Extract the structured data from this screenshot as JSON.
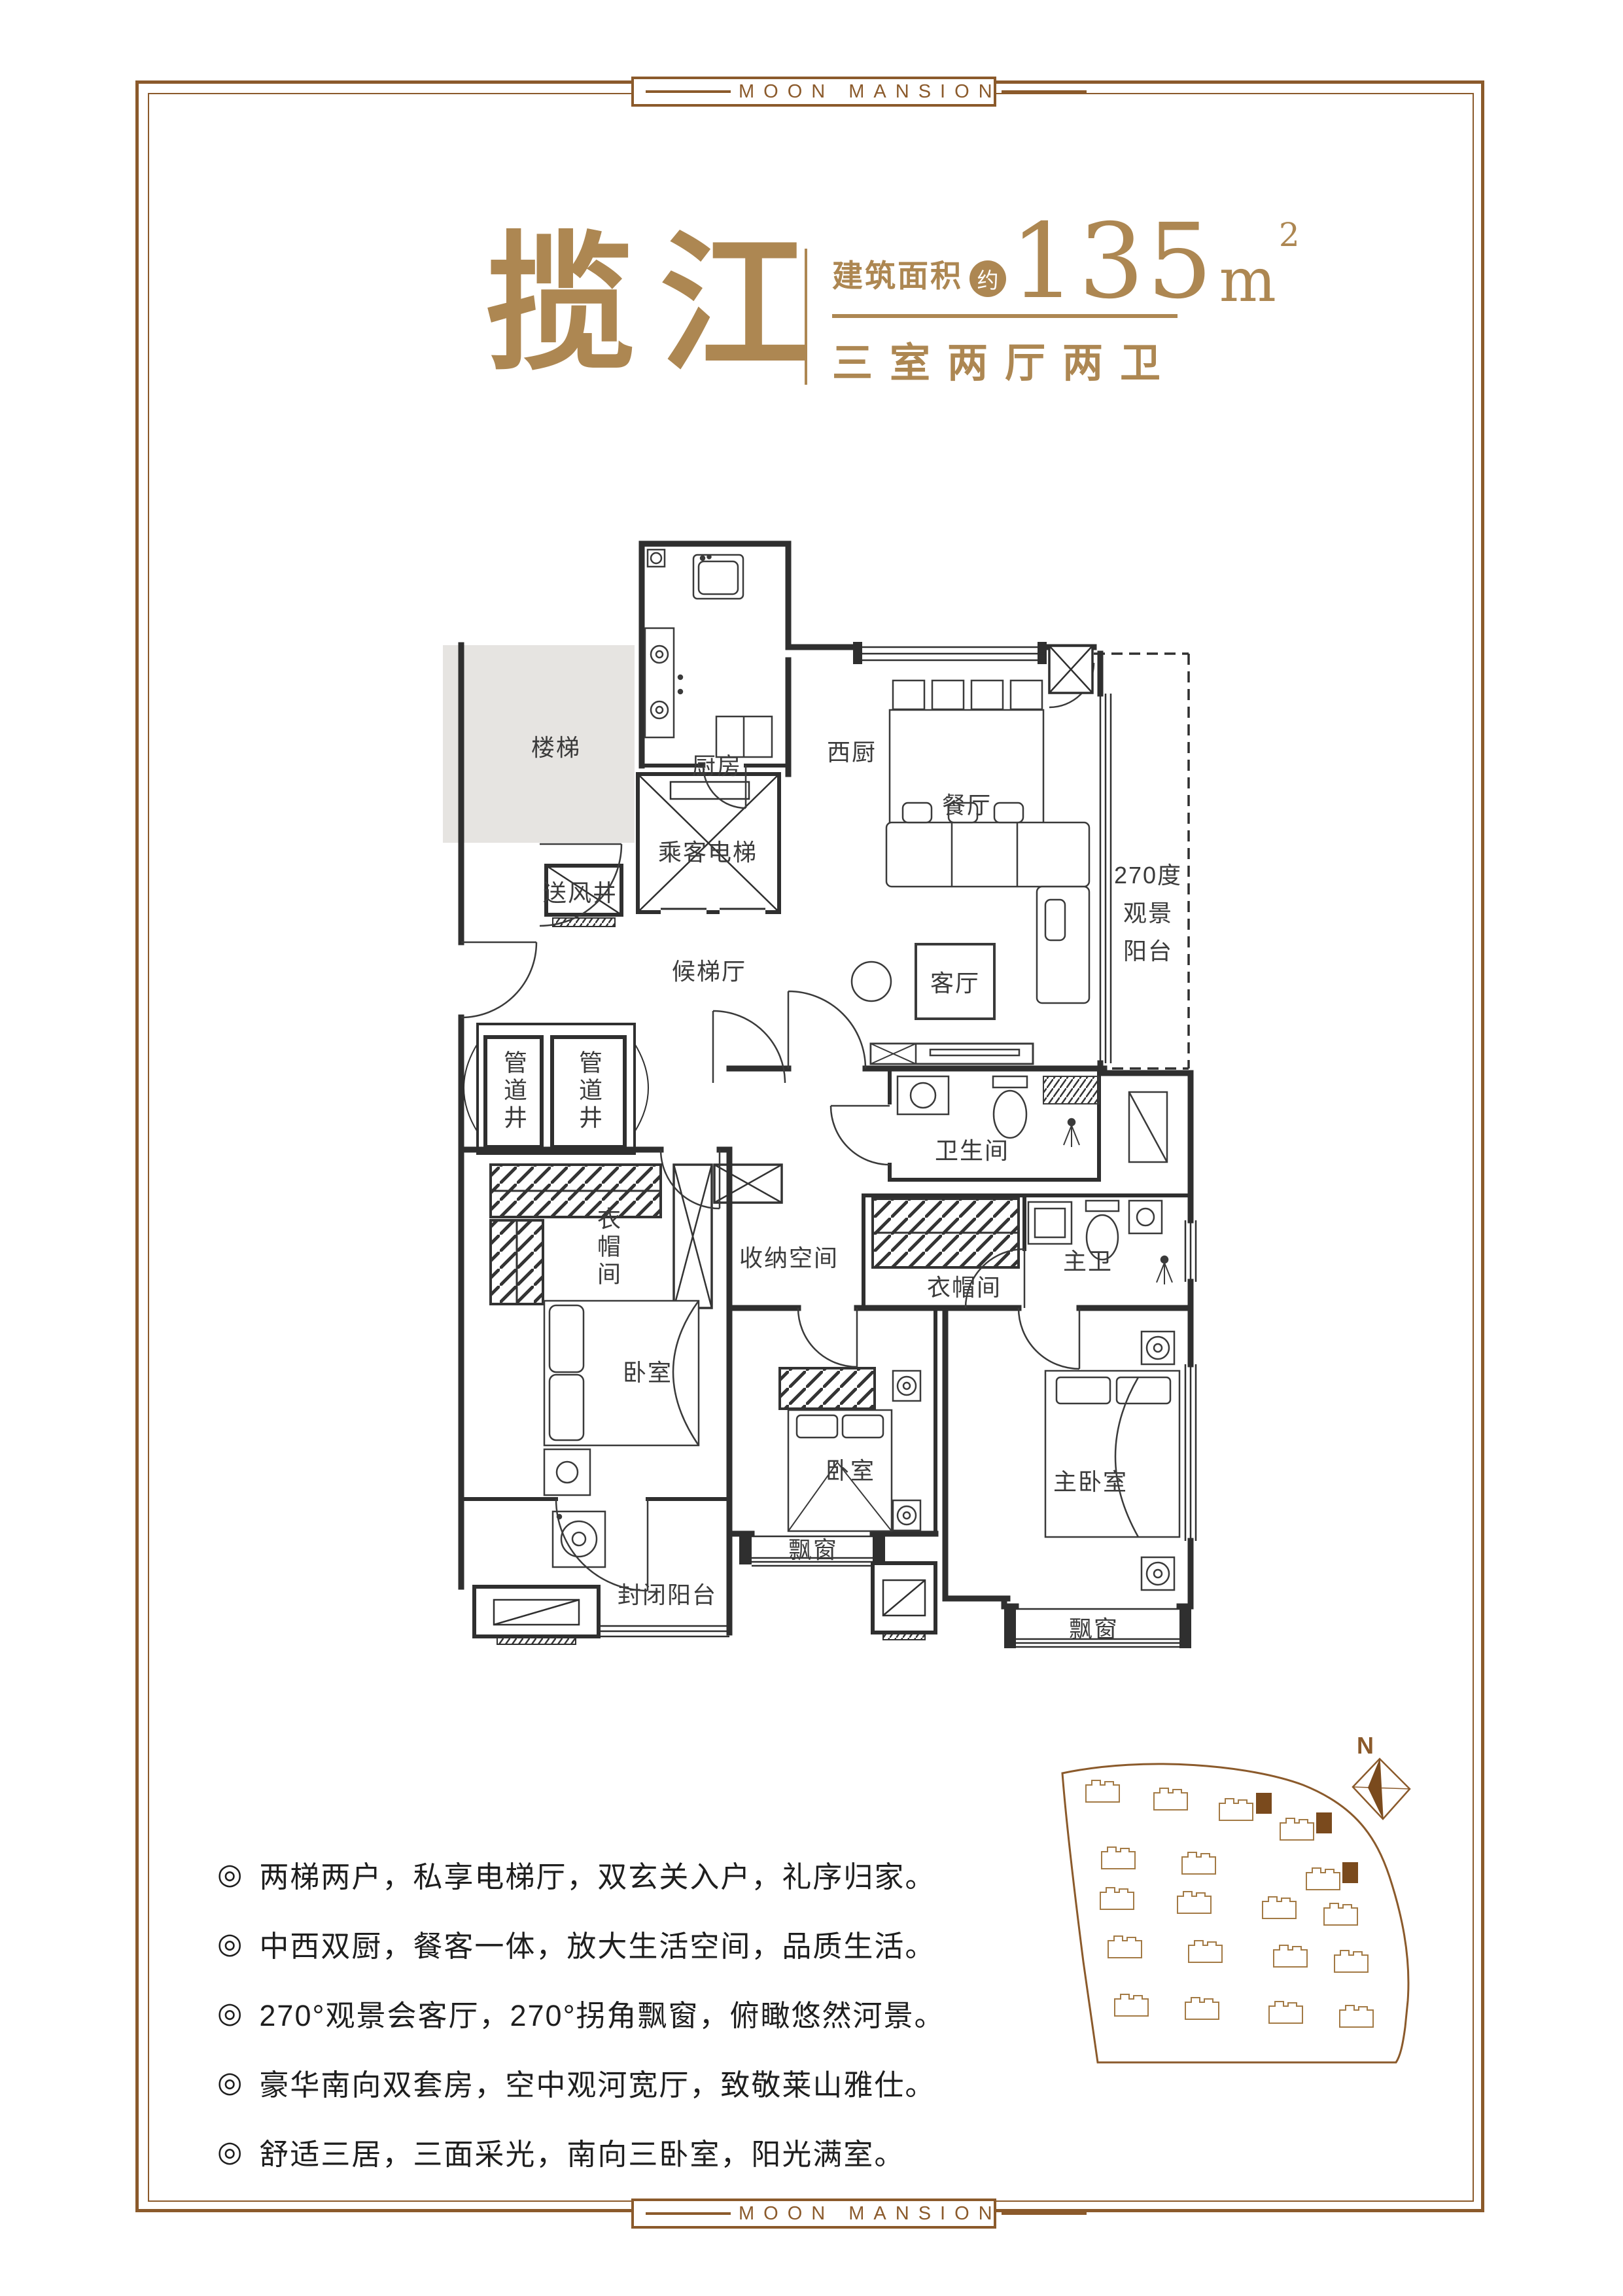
{
  "brand": {
    "badge_text": "MOON MANSION"
  },
  "title": {
    "name": "揽江",
    "area_label": "建筑面积",
    "area_circa": "约",
    "area_value": "135",
    "area_unit": "m",
    "area_exp": "2",
    "layout_text": "三室两厅两卫"
  },
  "floorplan": {
    "labels": {
      "stairs": "楼梯",
      "kitchen": "厨房",
      "west_kitchen": "西厨",
      "dining": "餐厅",
      "living": "客厅",
      "balcony_l1": "270度",
      "balcony_l2": "观景",
      "balcony_l3": "阳台",
      "elevator": "乘客电梯",
      "air_shaft": "送风井",
      "elevator_hall": "候梯厅",
      "pipe_shaft": "管道井",
      "cloakroom": "衣帽间",
      "storage": "收纳空间",
      "bathroom": "卫生间",
      "master_bath": "主卫",
      "bedroom": "卧室",
      "master_bedroom": "主卧室",
      "enclosed_balcony": "封闭阳台",
      "bay_window": "飘窗"
    }
  },
  "features": {
    "marker": "◎",
    "items": [
      "两梯两户，私享电梯厅，双玄关入户，礼序归家。",
      "中西双厨，餐客一体，放大生活空间，品质生活。",
      "270°观景会客厅，270°拐角飘窗，俯瞰悠然河景。",
      "豪华南向双套房，空中观河宽厅，致敬莱山雅仕。",
      "舒适三居，三面采光，南向三卧室，阳光满室。"
    ]
  },
  "siteplan": {
    "compass": "N"
  },
  "colors": {
    "gold": "#ad8752",
    "frame_brown": "#8b5a2b",
    "site_building_fill": "#7a4a1d",
    "plan_line": "#333333",
    "stairs_fill": "#e6e4e1"
  }
}
